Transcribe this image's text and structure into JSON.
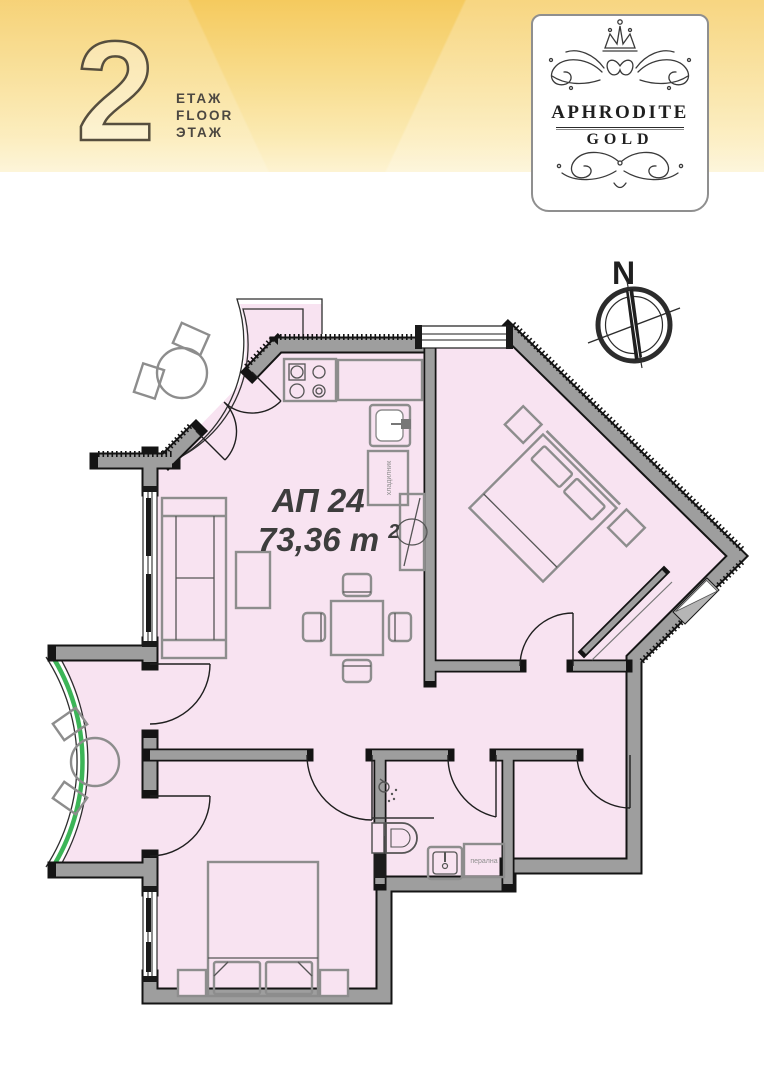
{
  "banner": {
    "floor_number": "2",
    "floor_labels": [
      "ЕТАЖ",
      "FLOOR",
      "ЭТАЖ"
    ]
  },
  "logo": {
    "name": "APHRODITE",
    "sub": "GOLD"
  },
  "compass": {
    "north": "N"
  },
  "plan": {
    "apartment": "АП 24",
    "area": "73,36 m",
    "area_exp": "2",
    "fridge": "хладилник",
    "washer": "перална"
  },
  "colors": {
    "banner_gold": "#f5ca5e",
    "room_pink": "#f8e3f1",
    "wall_gray": "#9e9e9e",
    "glazing_green": "#3cb557",
    "line_black": "#141414"
  }
}
